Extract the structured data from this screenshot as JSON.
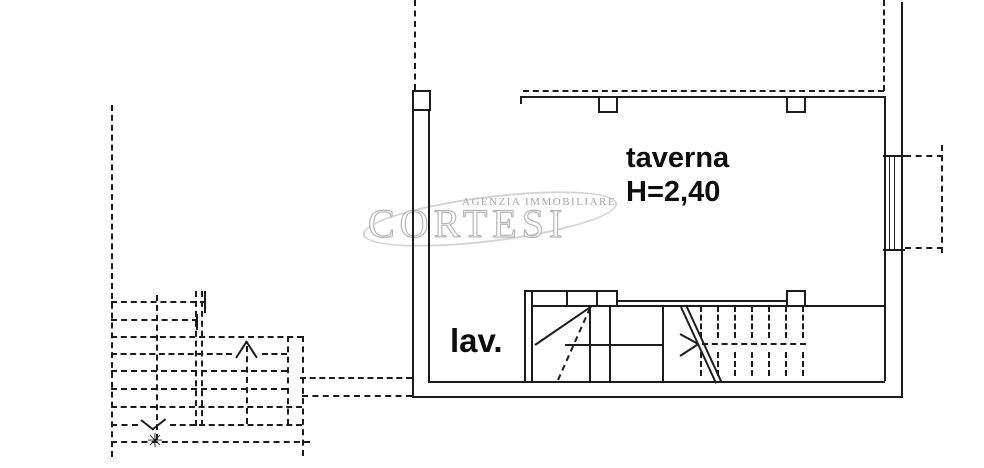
{
  "watermark": {
    "agency_type": "AGENZIA IMMOBILIARE",
    "agency_name": "CORTESI"
  },
  "labels": {
    "taverna": {
      "name": "taverna",
      "ceiling_height": "H=2,40"
    },
    "lav": {
      "name": "lav."
    }
  },
  "symbols": {
    "star": "✳"
  },
  "colors": {
    "line": "#1c1c1c",
    "background": "#ffffff",
    "watermark": "#b8b8b8"
  }
}
